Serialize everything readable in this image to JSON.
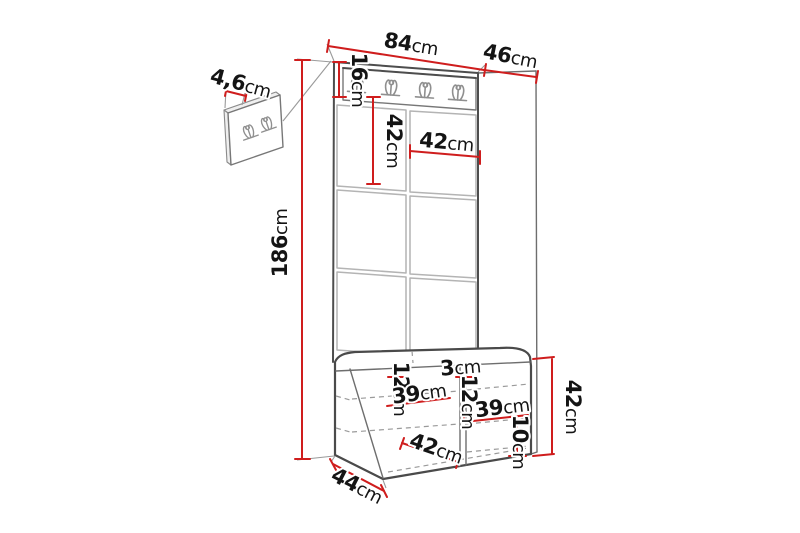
{
  "colors": {
    "dimension": "#cf1d1d",
    "text": "#141414",
    "outline": "#4d4d4d"
  },
  "dimensions": {
    "total_width": {
      "value": "84",
      "unit": "cm"
    },
    "total_depth": {
      "value": "46",
      "unit": "cm"
    },
    "total_height": {
      "value": "186",
      "unit": "cm"
    },
    "hook_rail_height": {
      "value": "16",
      "unit": "cm"
    },
    "wall_panel_thickness": {
      "value": "4,6",
      "unit": "cm"
    },
    "panel_tile_height": {
      "value": "42",
      "unit": "cm"
    },
    "panel_tile_width": {
      "value": "42",
      "unit": "cm"
    },
    "divider_thickness": {
      "value": "3",
      "unit": "cm"
    },
    "left_compartment_top_gap": {
      "value": "12",
      "unit": "cm"
    },
    "left_compartment_width": {
      "value": "39",
      "unit": "cm"
    },
    "right_compartment_top_gap": {
      "value": "12",
      "unit": "cm"
    },
    "right_compartment_width": {
      "value": "39",
      "unit": "cm"
    },
    "right_bottom_gap": {
      "value": "10",
      "unit": "cm"
    },
    "bench_opening_width": {
      "value": "42",
      "unit": "cm"
    },
    "bench_height": {
      "value": "42",
      "unit": "cm"
    },
    "bench_depth": {
      "value": "44",
      "unit": "cm"
    }
  }
}
